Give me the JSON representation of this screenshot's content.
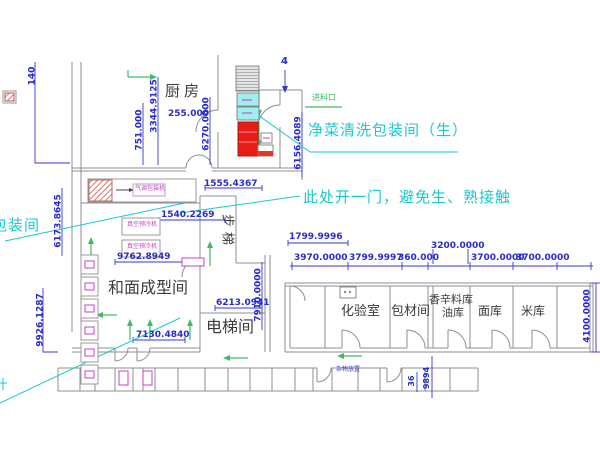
{
  "rooms": {
    "kitchen": "厨房",
    "stairs": "步梯",
    "dough_forming": "和面成型间",
    "elevator": "电梯间",
    "lab": "化验室",
    "packing_material": "包材间",
    "spice_store_line1": "香辛料库",
    "spice_store_line2": "油库",
    "flour_store": "面库",
    "rice_store": "米库"
  },
  "annotations": {
    "clean_wash_room": "净菜清洗包装间（生）",
    "door_note": "此处开一门，避免生、熟接触",
    "packing_room_cut": "包装间",
    "feed_inlet": "进料口",
    "misc_label": "杂物放置",
    "grid_axis": "4"
  },
  "equipment": {
    "packer_label": "气调包装机",
    "vacuum_cooler_1": "真空预冷机",
    "vacuum_cooler_2": "真空预冷机"
  },
  "dimensions": {
    "d140": "140",
    "d751": "751.000",
    "d3344": "3344.9125",
    "d255": "255.000",
    "d6270": "6270.0000",
    "d6156": "6156.4089",
    "d1555": "1555.4367",
    "d1540": "1540.2269",
    "d6173": "6173.8645",
    "d9762": "9762.8949",
    "d9926": "9926.1287",
    "d7130": "7130.4840",
    "d6213": "6213.0941",
    "d7910": "7910.0000",
    "d1799": "1799.9996",
    "d3970": "3970.0000",
    "d3799": "3799.9997",
    "d360": "360.000",
    "d3200": "3200.0000",
    "d3700a": "3700.0000",
    "d3700b": "3700.0000",
    "d4100": "4100.0000",
    "d9894": "9894",
    "d36": "36"
  },
  "colors": {
    "dimension": "#2a2acd",
    "annotation": "#1ac8cd",
    "wall": "#8f8f8f",
    "room_text": "#3b3b3b",
    "arrow_green": "#3dbb63",
    "equipment_magenta": "#c23fc2",
    "equipment_red": "#e81c16",
    "equipment_cyan": "#9feef0",
    "background": "#ffffff"
  }
}
